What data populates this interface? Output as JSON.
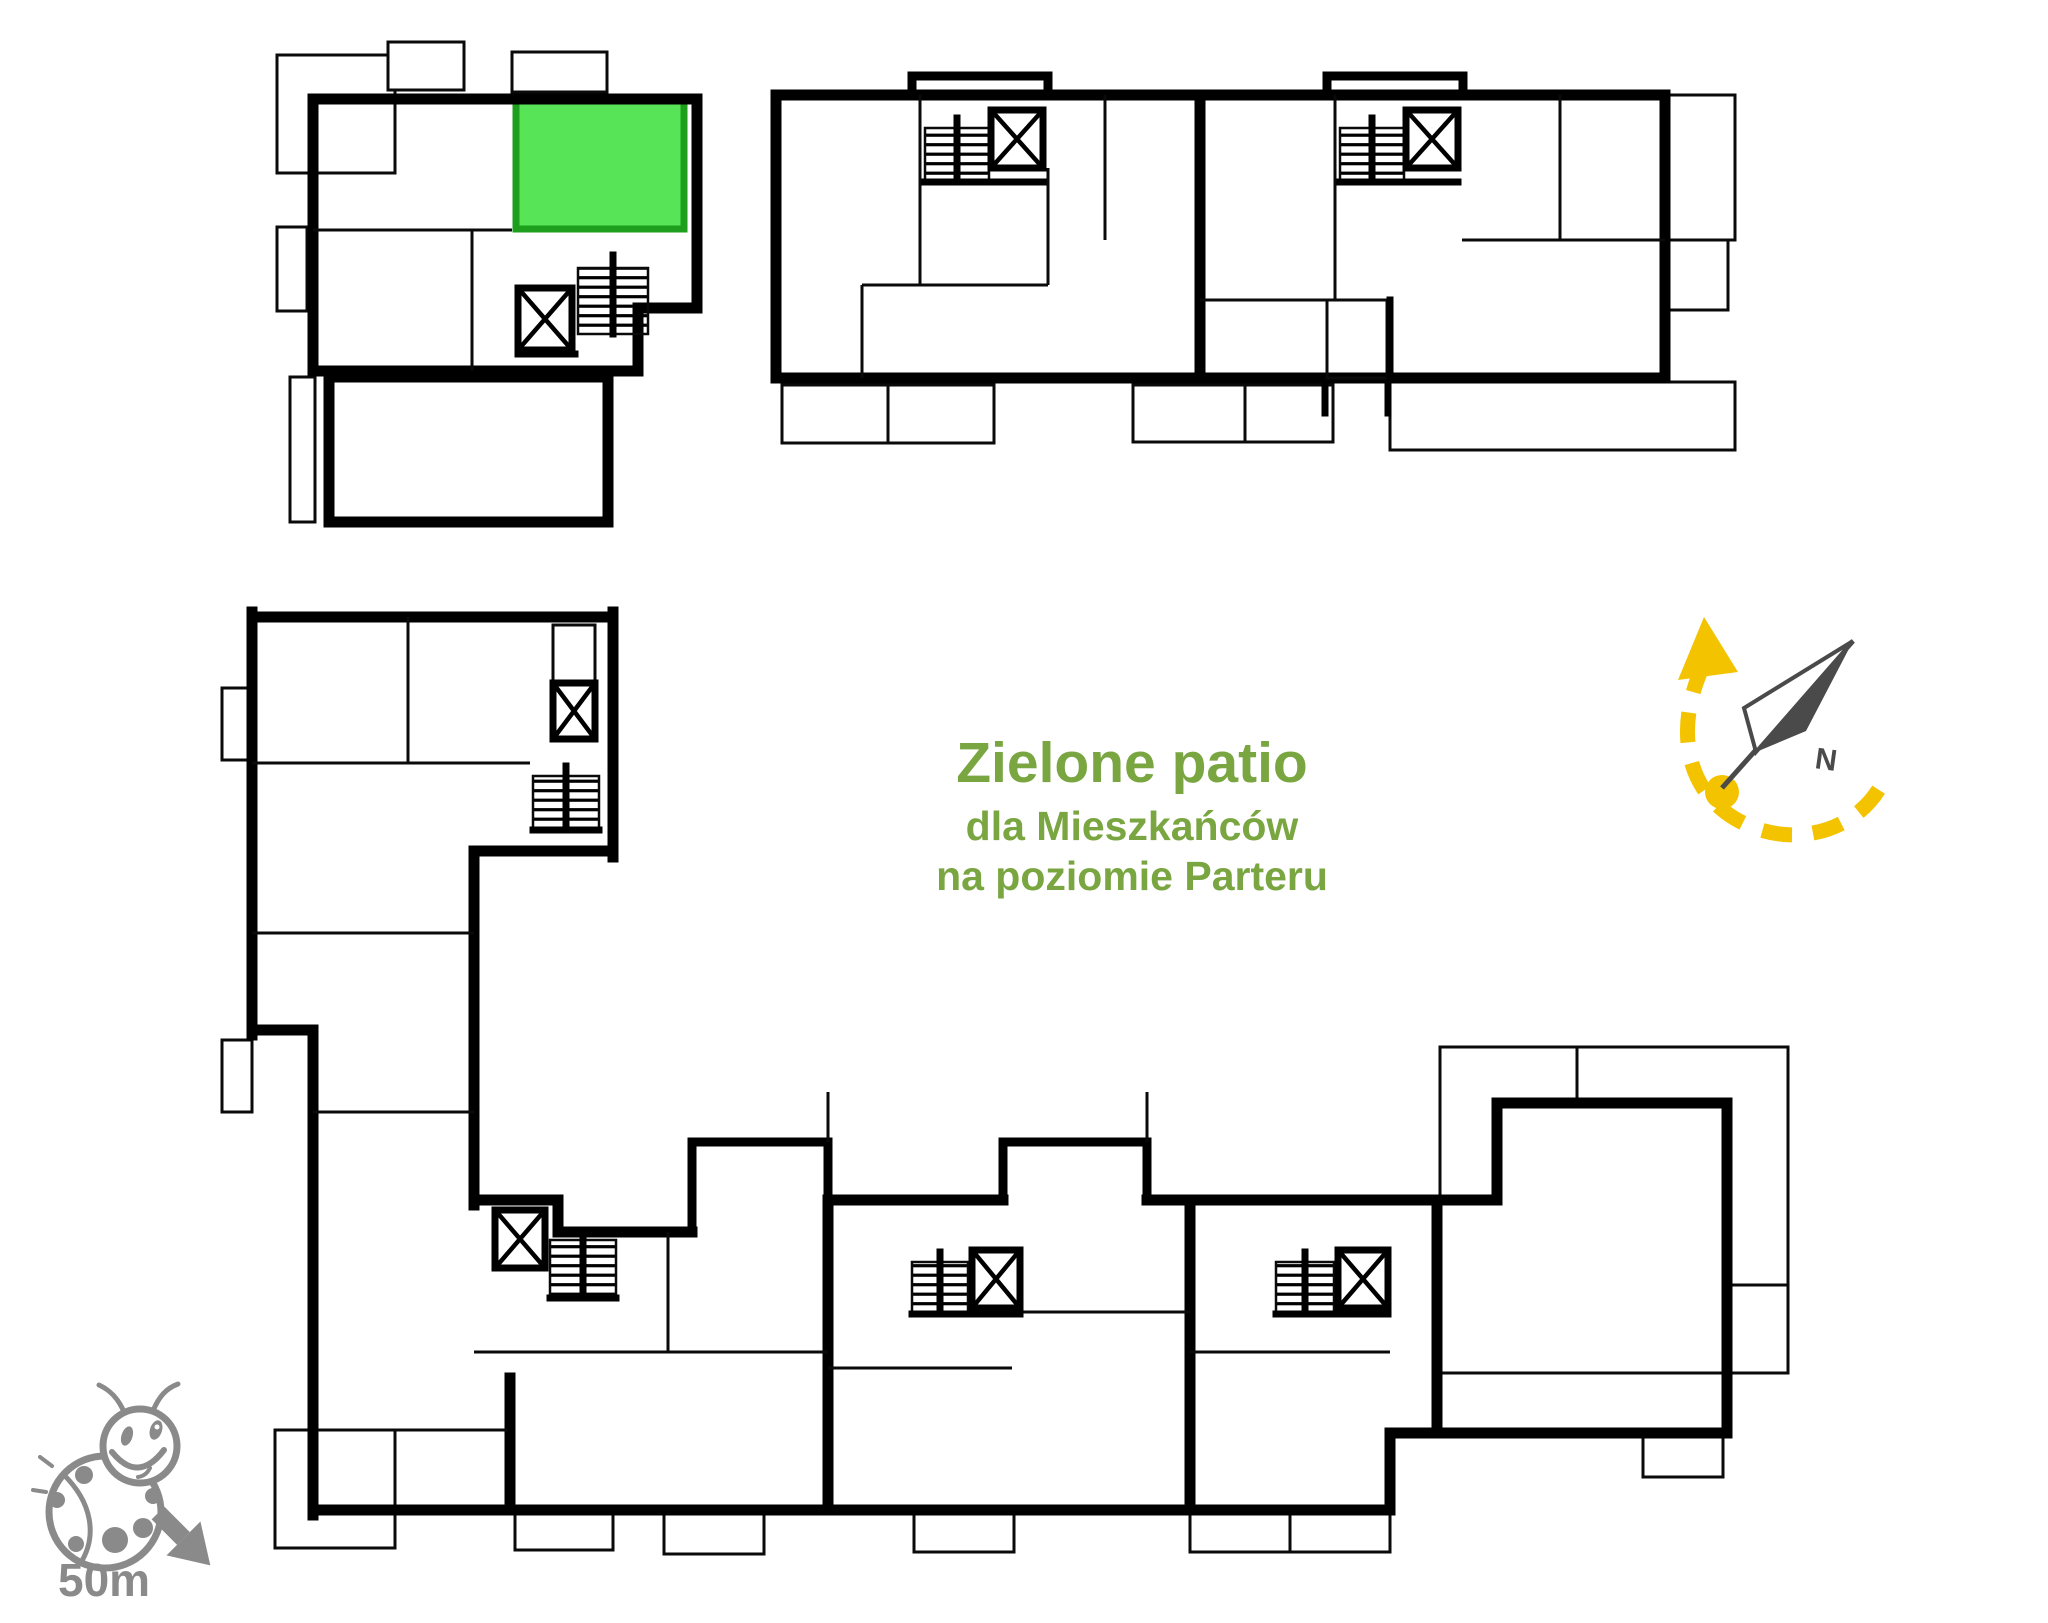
{
  "canvas": {
    "width": 2048,
    "height": 1623,
    "background": "#ffffff"
  },
  "patio_label": {
    "title": "Zielone patio",
    "subtitle_line1": "dla Mieszkańców",
    "subtitle_line2": "na poziomie Parteru",
    "color": "#7aa642"
  },
  "compass": {
    "north_label": "N",
    "needle_color": "#4a4a4a",
    "arrow_color": "#f3c300"
  },
  "scale_indicator": {
    "label": "50m",
    "color": "#8a8a8a",
    "icon": "ladybug-icon",
    "arrow_direction": "south-east"
  },
  "highlighted_unit": {
    "fill": "#57e457",
    "border": "#1d9e1d",
    "location": "top-left building, upper-right unit"
  },
  "floorplan": {
    "wall_color": "#000000",
    "buildings": [
      "top-left-building",
      "top-right-building",
      "l-shaped-bottom-building"
    ],
    "stair_core_count": 7
  }
}
